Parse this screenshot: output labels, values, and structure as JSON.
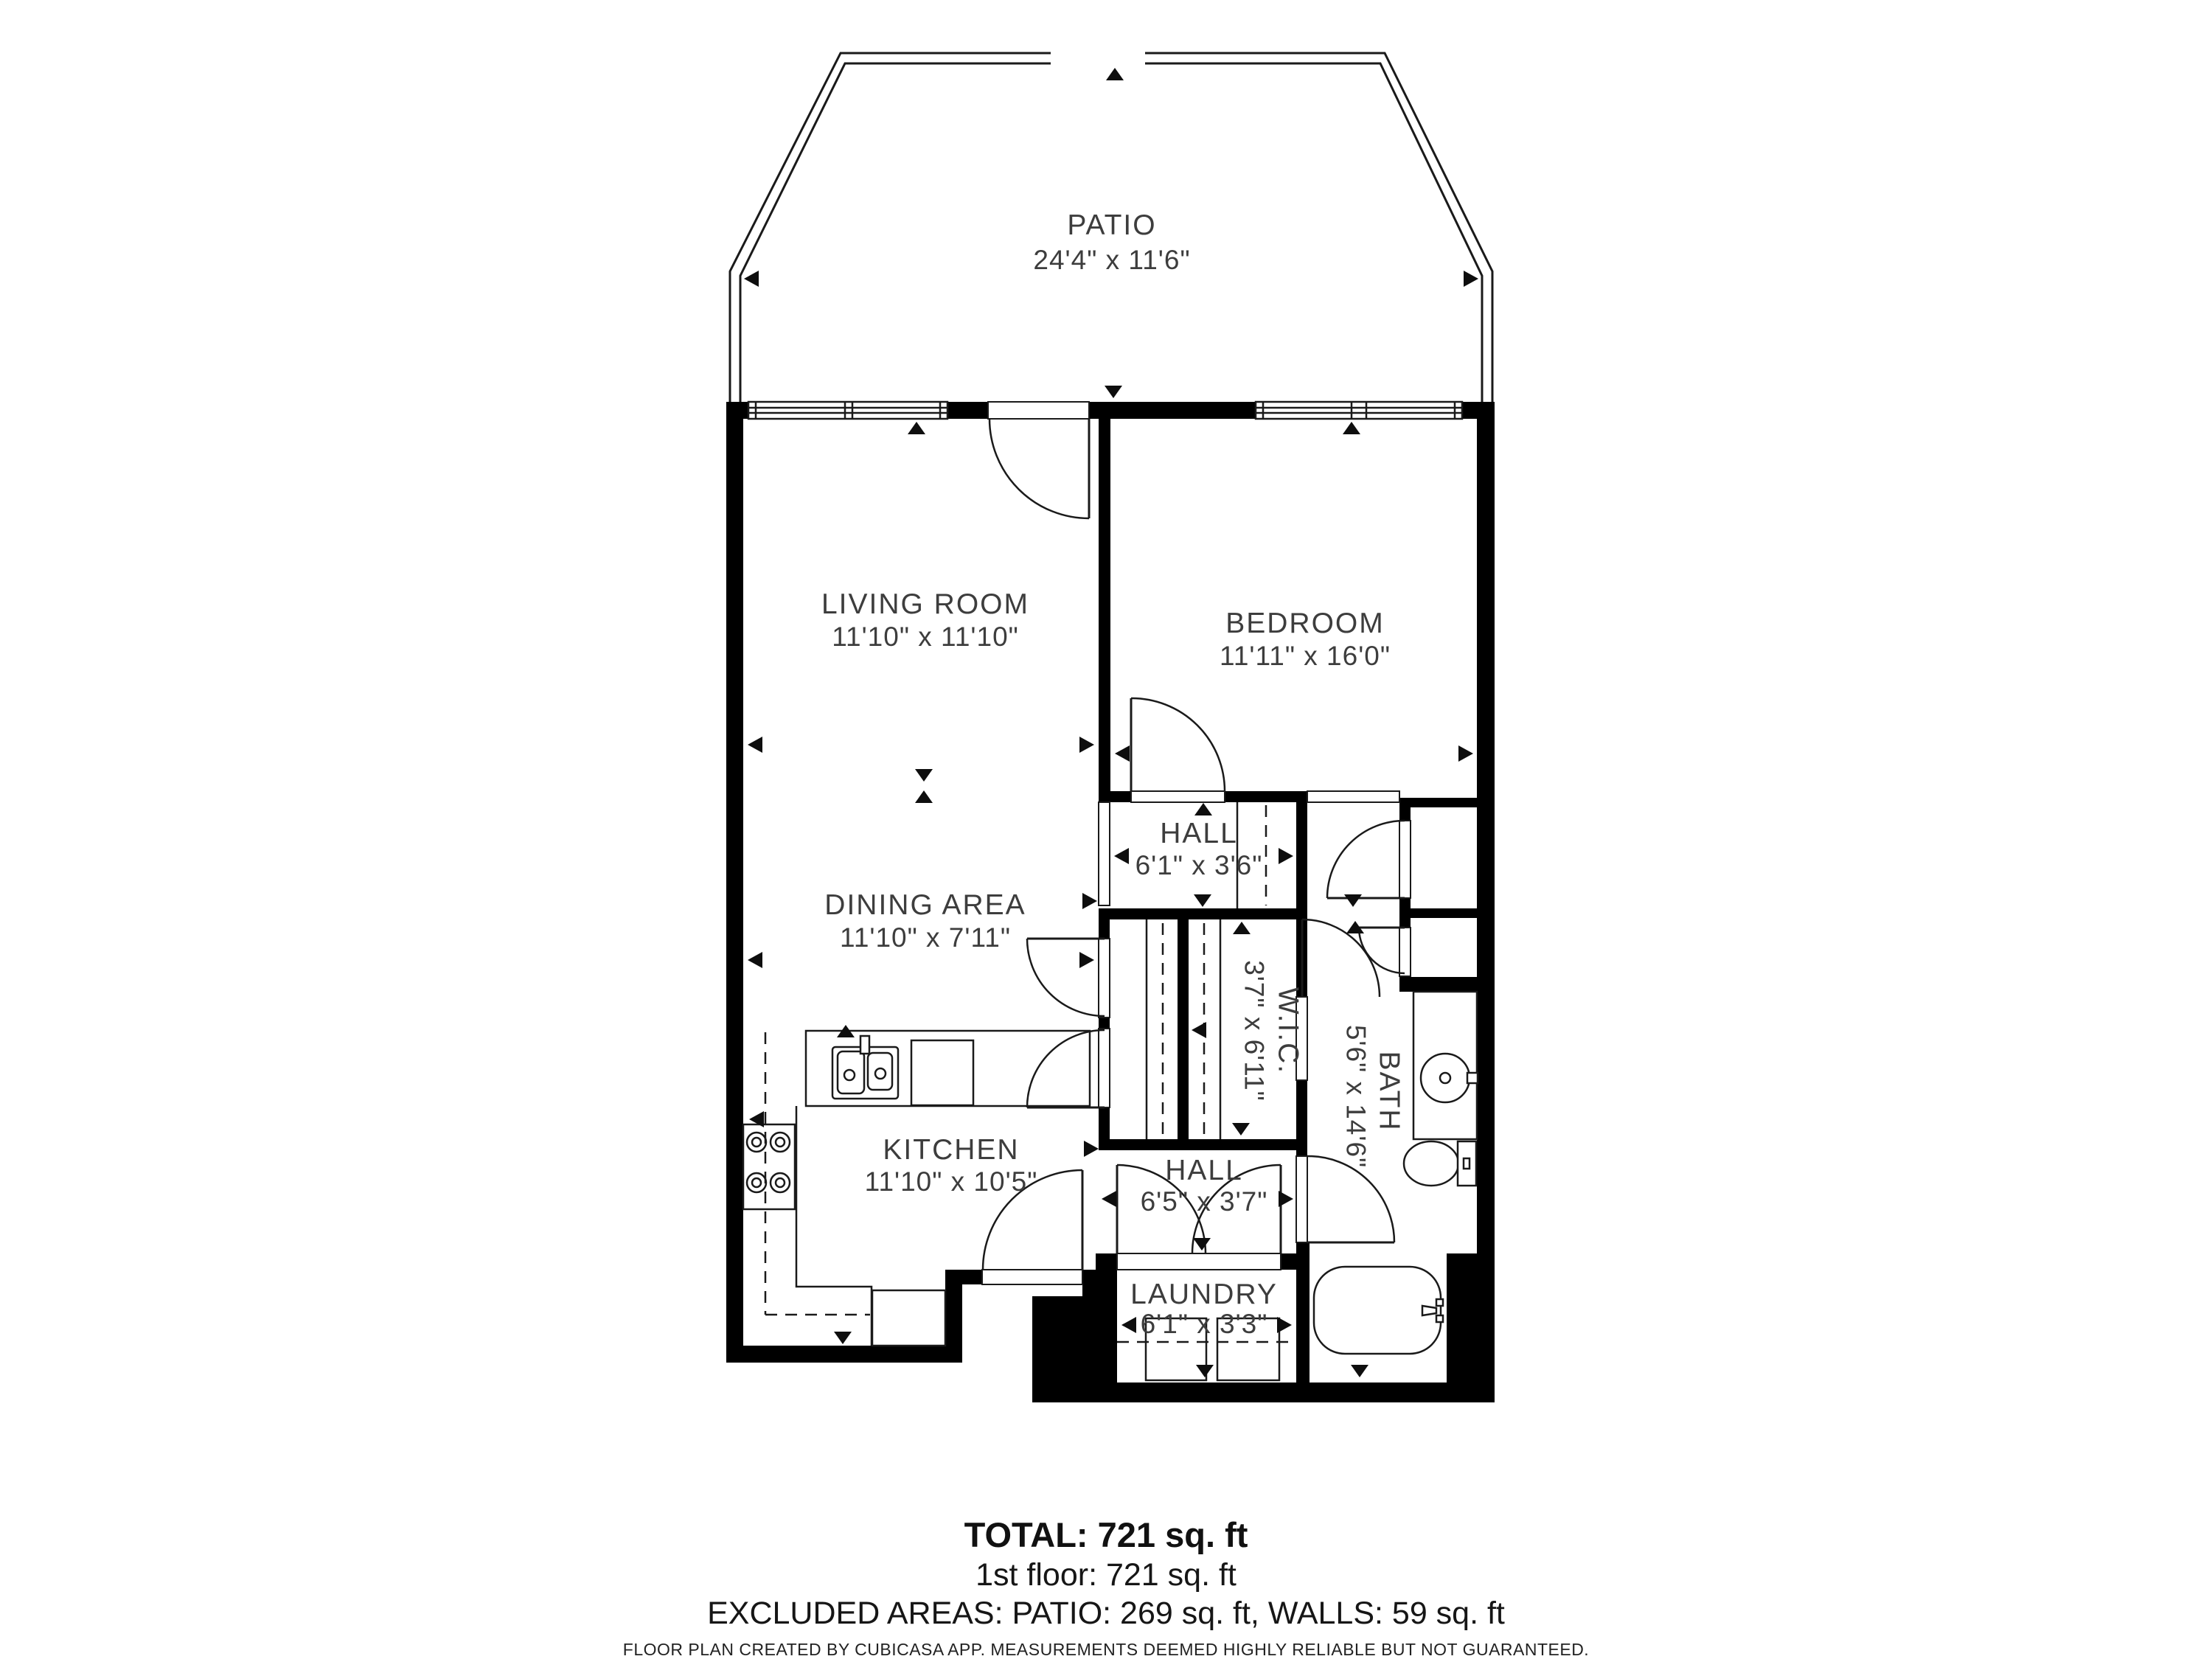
{
  "rooms": {
    "patio": {
      "name": "PATIO",
      "dims": "24'4\" x 11'6\""
    },
    "living_room": {
      "name": "LIVING ROOM",
      "dims": "11'10\" x 11'10\""
    },
    "dining_area": {
      "name": "DINING AREA",
      "dims": "11'10\" x 7'11\""
    },
    "kitchen": {
      "name": "KITCHEN",
      "dims": "11'10\" x 10'5\""
    },
    "bedroom": {
      "name": "BEDROOM",
      "dims": "11'11\" x 16'0\""
    },
    "hall_upper": {
      "name": "HALL",
      "dims": "6'1\" x 3'6\""
    },
    "wic": {
      "name": "W.I.C.",
      "dims": "3'7\" x 6'11\""
    },
    "bath": {
      "name": "BATH",
      "dims": "5'6\" x 14'6\""
    },
    "hall_lower": {
      "name": "HALL",
      "dims": "6'5\" x 3'7\""
    },
    "laundry": {
      "name": "LAUNDRY",
      "dims": "6'1\" x 3'3\""
    }
  },
  "summary": {
    "total": "TOTAL: 721 sq. ft",
    "floor1": "1st floor: 721 sq. ft",
    "excluded": "EXCLUDED AREAS: PATIO: 269 sq. ft, WALLS: 59 sq. ft",
    "disclaimer": "FLOOR PLAN CREATED BY CUBICASA APP. MEASUREMENTS DEEMED HIGHLY RELIABLE BUT NOT GUARANTEED."
  },
  "colors": {
    "wall": "#000000",
    "line": "#1a1a1a",
    "text": "#3d3d3d",
    "background": "#ffffff"
  }
}
